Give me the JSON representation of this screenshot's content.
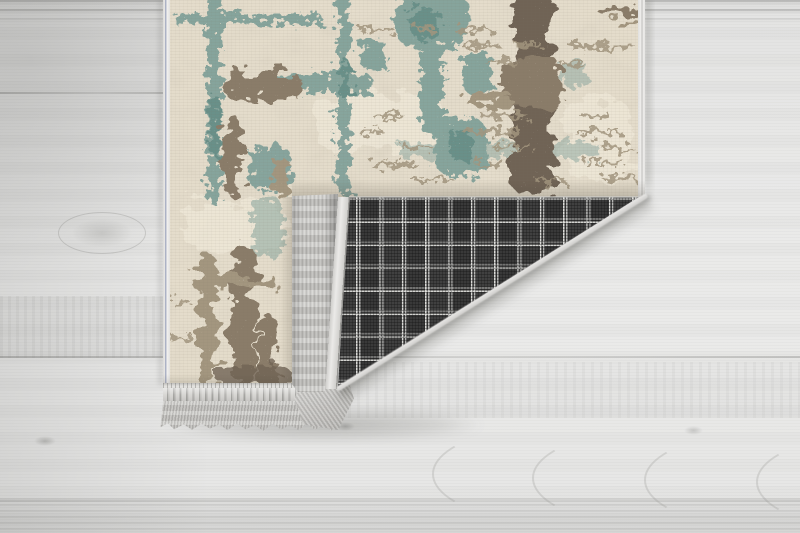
{
  "meta": {
    "alt": "Product photo of a distressed cream rug with teal and taupe abstract pattern lying on a whitewashed grey wood floor; its bottom-right corner is folded over, revealing a dark grey checked woven backing, a pale binding strip and grey fringe tassels"
  },
  "scene": {
    "floor_label": "whitewashed grey wood plank floor",
    "rug_label": "distressed cream rug with teal and taupe abstract pattern",
    "backing_label": "dark grey plaid woven rug backing on folded corner",
    "fringe_bottom_label": "grey fringe tassels on bottom edge of rug",
    "fringe_band_label": "grey fringe along folded corner edge",
    "binding_label": "pale satin binding strip"
  },
  "colors": {
    "floor-base": "#e7e7e6",
    "floor-grain": "#c9c9c7",
    "rug-base": "#e5ddcc",
    "rug-mottle": "#cfc5b0",
    "teal": "#7fa099",
    "teal-dark": "#628c85",
    "taupe": "#8a7c69",
    "taupe-dark": "#6f6354",
    "taupe-light": "#a3967f",
    "plaid-base": "#404040",
    "plaid-line": "#d8d8d6",
    "fringe-light": "#cfcecb",
    "fringe-dark": "#a9a8a5",
    "binding": "#eceae7",
    "shadow": "#55524a"
  }
}
